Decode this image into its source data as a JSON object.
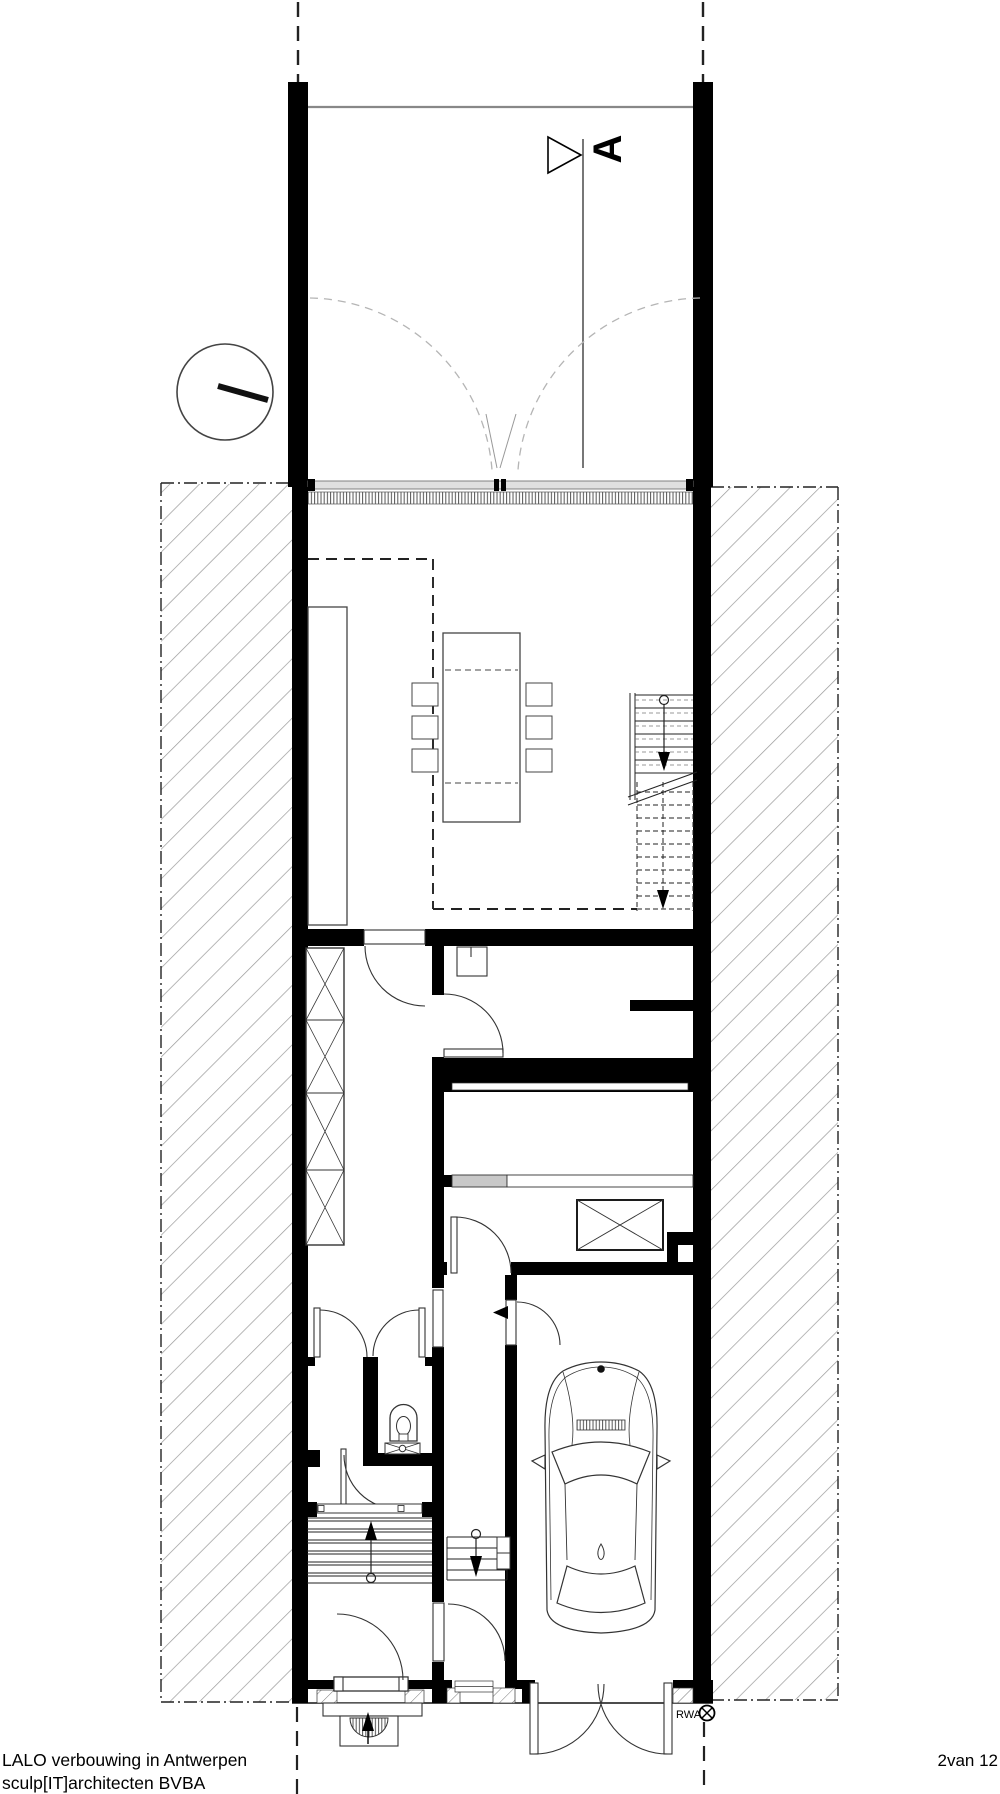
{
  "labels": {
    "section_marker": "A",
    "vent": "RWA"
  },
  "footer": {
    "project_title": "LALO verbouwing in Antwerpen",
    "firm": "sculp[IT]architecten BVBA",
    "sheet_number": "2van 12"
  },
  "colors": {
    "ink": "#1a1a1a",
    "wall_fill": "#000000",
    "hatch": "#9a9a9a",
    "glass": "#e0e0e0",
    "dashed_swing": "#b5b5b5",
    "partition_gray": "#c8c8c8"
  }
}
